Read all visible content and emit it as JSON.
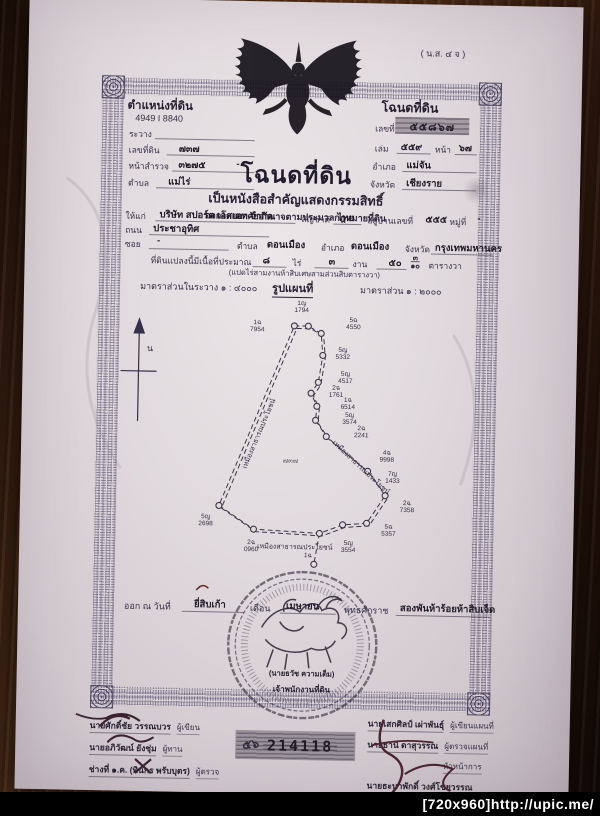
{
  "watermark": "[720x960]http://upic.me/",
  "form_code": "( น.ส. ๔ จ )",
  "header_left": {
    "title": "ตำแหน่งที่ดิน",
    "map_sheet": "4949 I 8840",
    "ravang_label": "ระวาง",
    "parcel_label": "เลขที่ดิน",
    "parcel_value": "๗๓๗",
    "survey_label": "หน้าสำรวจ",
    "survey_value": "๓๒๗๕",
    "survey_dash": "-",
    "tambon_label": "ตำบล",
    "tambon_value": "แม่ไร่"
  },
  "header_right": {
    "title": "โฉนดที่ดิน",
    "number_label": "เลขที่",
    "number_value": "๕๕๘๖๗",
    "book_label": "เล่ม",
    "book_value": "๕๕๙",
    "page_label": "หน้า",
    "page_value": "๖๗",
    "amphoe_label": "อำเภอ",
    "amphoe_value": "แม่จัน",
    "province_label": "จังหวัด",
    "province_value": "เชียงราย"
  },
  "title_block": {
    "title": "โฉนดที่ดิน",
    "subtitle1": "เป็นหนังสือสำคัญแสดงกรรมสิทธิ์",
    "subtitle2": "ออกโดยอาศัยอำนาจตามประมวลกฎหมายที่ดิน"
  },
  "owner": {
    "grant_label": "ให้แก่",
    "name": "บริษัท สปอร์ต เอสเตท จำกัด",
    "nationality_label": "สัญชาติ",
    "nationality": "ไทย",
    "address_label": "อยู่บ้านเลขที่",
    "address_no": "๕๕๕",
    "moo_label": "หมู่ที่",
    "moo": "-",
    "road_label": "ถนน",
    "road": "ประชาอุทิศ",
    "soi_label": "ซอย",
    "soi": "-",
    "tambon_label": "ตำบล",
    "tambon": "ดอนเมือง",
    "amphoe_label": "อำเภอ",
    "amphoe": "ดอนเมือง",
    "province_label": "จังหวัด",
    "province": "กรุงเทพมหานคร"
  },
  "area": {
    "prefix": "ที่ดินแปลงนี้มีเนื้อที่ประมาณ",
    "rai": "๘",
    "rai_label": "ไร่",
    "ngan": "๓",
    "ngan_label": "งาน",
    "wa": "๕๐",
    "wa_frac_top": "๓",
    "wa_frac_bottom": "๑๐",
    "wa_label": "ตารางวา",
    "in_words": "(แปดไร่สามงานห้าสิบเศษสามส่วนสิบตารางวา)"
  },
  "scale": {
    "left": "มาตราส่วนในระวาง  ๑ : ๔๐๐๐",
    "map_title": "รูปแผนที่",
    "right": "มาตราส่วน  ๑ : ๒๐๐๐"
  },
  "map": {
    "north_label": "น",
    "parcel_number": "๗๓๗",
    "vertices": [
      [
        215,
        30
      ],
      [
        229,
        30
      ],
      [
        242,
        37
      ],
      [
        244,
        59
      ],
      [
        240,
        86
      ],
      [
        233,
        97
      ],
      [
        239,
        110
      ],
      [
        238,
        124
      ],
      [
        249,
        140
      ],
      [
        291,
        174
      ],
      [
        309,
        198
      ],
      [
        291,
        226
      ],
      [
        267,
        228
      ],
      [
        244,
        237
      ],
      [
        178,
        234
      ],
      [
        143,
        211
      ]
    ],
    "spur": [
      [
        244,
        237
      ],
      [
        239,
        268
      ]
    ],
    "points": [
      {
        "code": "1ญ",
        "num": "1794",
        "x": 222,
        "y": 4
      },
      {
        "code": "1ฉ",
        "num": "7954",
        "x": 178,
        "y": 24
      },
      {
        "code": "5ฉ",
        "num": "4550",
        "x": 274,
        "y": 20
      },
      {
        "code": "5ญ",
        "num": "5332",
        "x": 264,
        "y": 50
      },
      {
        "code": "5ญ",
        "num": "4517",
        "x": 267,
        "y": 74
      },
      {
        "code": "2ฉ",
        "num": "1761",
        "x": 258,
        "y": 88
      },
      {
        "code": "1ฉ",
        "num": "6514",
        "x": 270,
        "y": 100
      },
      {
        "code": "5ญ",
        "num": "3574",
        "x": 272,
        "y": 115
      },
      {
        "code": "2ฉ",
        "num": "2241",
        "x": 284,
        "y": 128
      },
      {
        "code": "4ฉ",
        "num": "9998",
        "x": 310,
        "y": 152
      },
      {
        "code": "7ญ",
        "num": "1433",
        "x": 316,
        "y": 173
      },
      {
        "code": "2ฉ",
        "num": "7358",
        "x": 331,
        "y": 202
      },
      {
        "code": "5ฉ",
        "num": "5357",
        "x": 313,
        "y": 226
      },
      {
        "code": "5ญ",
        "num": "3554",
        "x": 273,
        "y": 243
      },
      {
        "code": "2ฉ",
        "num": "0960",
        "x": 176,
        "y": 244
      },
      {
        "code": "5ญ",
        "num": "2698",
        "x": 130,
        "y": 219
      },
      {
        "code": "1ฉ",
        "num": "",
        "x": 233,
        "y": 256
      }
    ],
    "edge_labels": [
      {
        "text": "เหมืองสาธารณประโยชน์",
        "x": 168,
        "y": 168,
        "rot": -68
      },
      {
        "text": "เหมืองสาธารณประโยชน์",
        "x": 256,
        "y": 140,
        "rot": 42
      },
      {
        "text": "เหมืองสาธารณประโยชน์",
        "x": 182,
        "y": 246,
        "rot": 0
      }
    ]
  },
  "issue": {
    "prefix": "ออก ณ วันที่",
    "day": "ยี่สิบเก้า",
    "month_label": "เดือน",
    "month": "เมษายน",
    "era_label": "พุทธศักราช",
    "year": "สองพันห้าร้อยห้าสิบเจ็ด"
  },
  "seal": {
    "officer_name": "(นายธวัช ความเต็ม)",
    "officer_title": "เจ้าพนักงานที่ดิน"
  },
  "signatures_left": [
    {
      "name": "นายศักดิ์ชัย วรรณบวร",
      "role": "ผู้เขียน"
    },
    {
      "name": "นายอภิวัฒน์ ยังชุ่ม",
      "role": "ผู้ทาน"
    },
    {
      "name": "ช่างที่ ๑.ค.  (ทินกร พรับบุตร)",
      "role": "ผู้ตรวจ"
    }
  ],
  "stamp": {
    "prefix": "๕๖",
    "number": "214118"
  },
  "signatures_right": [
    {
      "name": "นายเสกศิลป์ เผ่าพันธุ์",
      "role": "ผู้เขียนแผนที่"
    },
    {
      "name": "นายธานี ดาสุวรรณ",
      "role": "ผู้ตรวจแผนที่"
    },
    {
      "name": "",
      "role": "หัวหน้าการ"
    },
    {
      "name": "นายธะนาพักดิ์ วงศ์โชยวรรณ",
      "role": ""
    }
  ]
}
